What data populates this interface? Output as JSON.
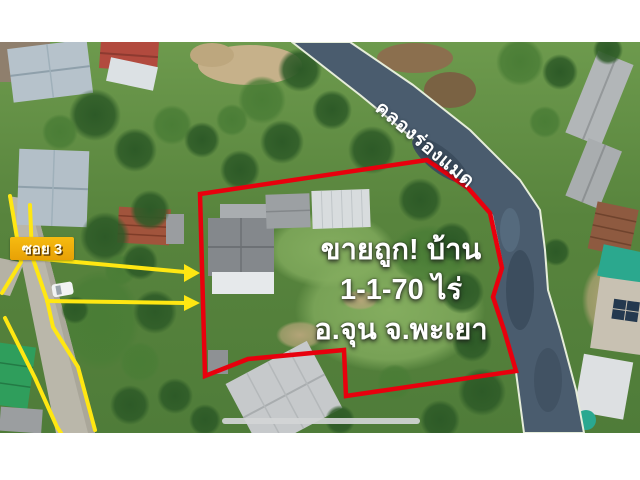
{
  "overlay": {
    "soi_label": "ซอย 3",
    "canal_label": "คลองร่องแมด",
    "ad_line1": "ขายถูก! บ้าน",
    "ad_line2": "1-1-70 ไร่",
    "ad_line3": "อ.จุน จ.พะเยา"
  },
  "colors": {
    "boundary_red": "#e8000d",
    "road_marking_yellow": "#ffe712",
    "soi_label_bg": "#edaa0a",
    "canal_water": "#4a5c6e",
    "overlay_text": "#ffffff"
  }
}
